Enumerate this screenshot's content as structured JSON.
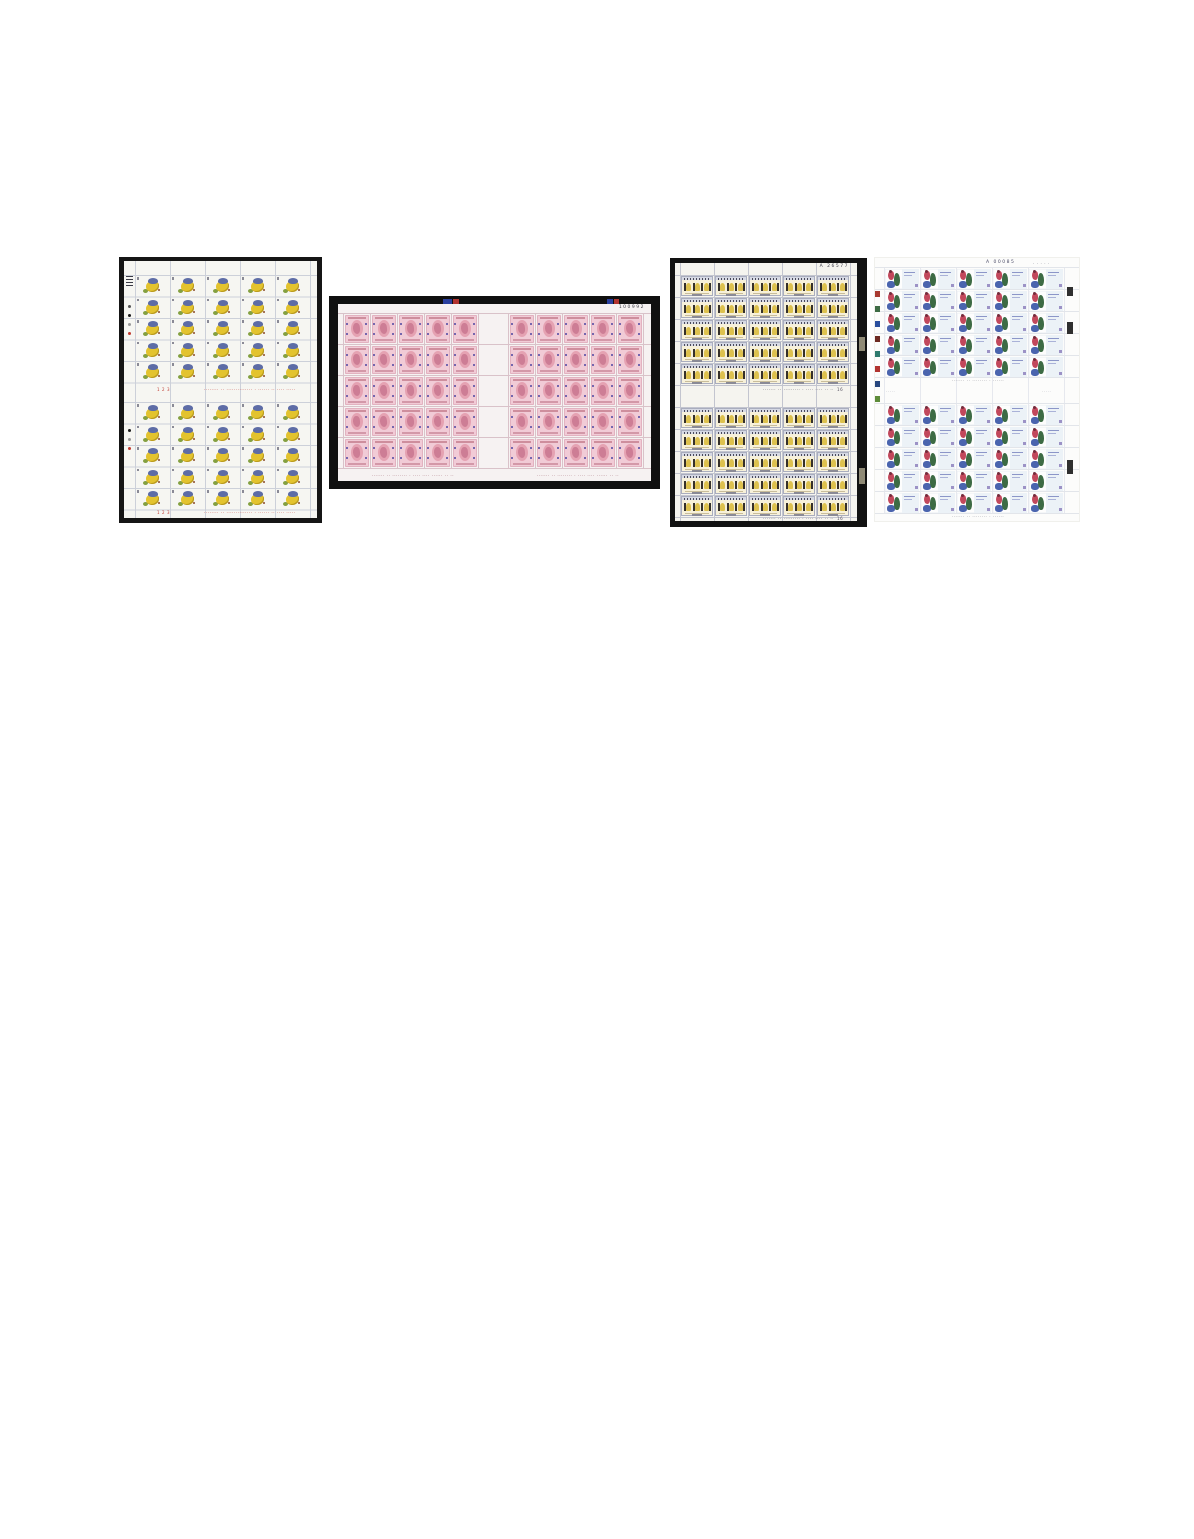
{
  "page": {
    "title": "Four full sheets of postage stamps on a white page",
    "background": "#ffffff"
  },
  "sheets": [
    {
      "id": "sheet-1",
      "kind": "flower-stamp-full-sheet",
      "layout": "2 panes of 25 stamps (5 columns x 5 rows), vertical sheet on black backdrop",
      "stamp_count": 50,
      "colors": {
        "backdrop": "#151515",
        "paper": "#f6f6f2",
        "grid_line": "#ccd0d9",
        "bloom": "#e3c32e",
        "cap": "#5d6ca6",
        "leaf": "#84a040",
        "imprint": "#c03a30"
      },
      "plate_dots_pane1": [
        "#555555",
        "#1a1a1a",
        "#999999",
        "#c03a30"
      ],
      "plate_dots_pane2": [
        "#1a1a1a",
        "#999999",
        "#c03a30"
      ],
      "imprints": {
        "gutter_left": "1 2 3",
        "gutter_center": "········ ·· ·············· · ······ ·· ···· ·····",
        "bottom_left": "1 2 3",
        "bottom_center": "········ ·· ·············· · ······ ·· ···· ·····"
      }
    },
    {
      "id": "sheet-2",
      "kind": "pink-portrait-stamp-full-sheet",
      "layout": "2 panes of 25 stamps (5 columns x 5 rows), horizontal sheet with wide black frame",
      "stamp_count": 50,
      "serial": "100992",
      "colors": {
        "backdrop": "#101010",
        "paper": "#f6f2f2",
        "grid_line": "#d9c2c9",
        "stamp": "#f1cbd6",
        "oval": "#e5a2b2",
        "head": "#cd7d95",
        "ornament": "#7566ae",
        "imprint": "#9c5f6a",
        "registration_blue": "#2a3f9e",
        "registration_red": "#b23430"
      },
      "imprints": {
        "left_pane": "······· ·· ········ · ···· ···· ······ ·· ··",
        "right_pane": "······· ·· ········ · ···· ···· ······ ·· ··"
      }
    },
    {
      "id": "sheet-3",
      "kind": "figures-stamp-full-sheet",
      "layout": "2 panes of 25 stamps (5 columns x 5 rows), vertical sheet on black backdrop",
      "stamp_count": 50,
      "serial": "A 26577",
      "colors": {
        "backdrop": "#121212",
        "paper": "#f5f4ef",
        "grid_line": "#c3c5cf",
        "stamp_body": "#f7f1da",
        "band": "#d6d9e4",
        "figure": "#35302a",
        "arch": "#ddc14e",
        "imprint": "#55505f",
        "notch": "#8f8a76"
      },
      "imprints": {
        "gutter_right": "······· ·· ········· · ···· ···· ·· ····",
        "gutter_num": "16",
        "bottom_right": "······· ·· ········· · ···· ···· ·· ····",
        "bottom_num": "16"
      }
    },
    {
      "id": "sheet-4",
      "kind": "dancer-stamp-full-sheet",
      "layout": "2 panes of 25 stamps (5 columns x 5 rows), vertical white sheet, colour-control bar at left edge",
      "stamp_count": 50,
      "serial": "A 00085",
      "top_marks": "· · · · ·",
      "colors": {
        "paper": "#fcfcfb",
        "grid_line": "#e2e5ea",
        "red_figure": "#c2485c",
        "green_figure": "#3d6b44",
        "blue_shape": "#4a64ae",
        "panel": "#ecf2f7",
        "imprint": "#8a8a92",
        "edge_tab": "#2f2f2f"
      },
      "color_bar": [
        "#a83a30",
        "#3d6b44",
        "#2a4f9e",
        "#6e2a22",
        "#2f7a6e",
        "#b23430",
        "#28477f",
        "#5e8c3a"
      ],
      "imprints": {
        "above_gutter": "······· ·· ········ · ······",
        "gutter_left": "·····",
        "gutter_right": "·····",
        "bottom_center": "······· ·· ········ · ······"
      }
    }
  ]
}
